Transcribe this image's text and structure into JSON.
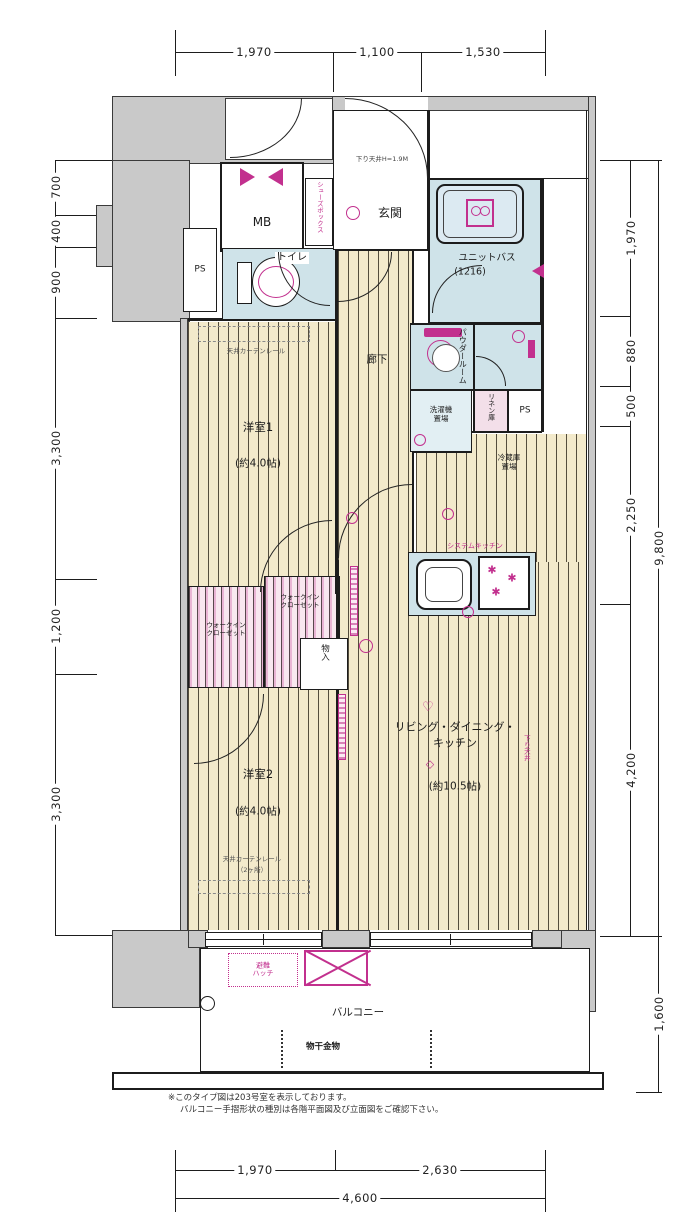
{
  "dims": {
    "top": [
      "1,970",
      "1,100",
      "1,530"
    ],
    "left": [
      "700",
      "400",
      "900",
      "3,300",
      "1,200",
      "3,300"
    ],
    "right_inner": [
      "1,970",
      "880",
      "500",
      "2,250",
      "4,200"
    ],
    "right_outer": [
      "9,800",
      "1,600"
    ],
    "bottom": [
      "1,970",
      "2,630"
    ],
    "bottom_total": "4,600"
  },
  "rooms": {
    "mb": "MB",
    "ps": "PS",
    "toilet": "トイレ",
    "entrance": "玄関",
    "entrance_note": "下り天井H=1.9M",
    "shoes_box": "シューズボックス",
    "unit_bath": "ユニットバス",
    "unit_bath_size": "(1216)",
    "powder_room": "パウダールーム",
    "washer_line1": "洗濯機",
    "washer_line2": "置場",
    "linen": "リネン庫",
    "fridge_line1": "冷蔵庫",
    "fridge_line2": "置場",
    "corridor": "廊下",
    "bedroom1": "洋室1",
    "bedroom1_size": "(約4.0帖)",
    "bedroom2": "洋室2",
    "bedroom2_size": "(約4.0帖)",
    "ldk_line1": "リビング・ダイニング・",
    "ldk_line2": "キッチン",
    "ldk_size": "(約10.5帖)",
    "wic_line1": "ウォークイン",
    "wic_line2": "クローゼット",
    "storage": "物入",
    "kitchen": "システムキッチン",
    "soffit": "下り天井",
    "curtain_rail": "天井カーテンレール",
    "curtain_rail_note": "（2ヶ所）",
    "balcony": "バルコニー",
    "laundry": "物干金物",
    "hatch_line1": "避難",
    "hatch_line2": "ハッチ"
  },
  "icons": {
    "heart": "♡",
    "diamond": "◇",
    "burner": "✱"
  },
  "notes": [
    "※このタイプ図は203号室を表示しております。",
    "バルコニー手摺形状の種別は各階平面図及び立面図をご確認下さい。"
  ]
}
